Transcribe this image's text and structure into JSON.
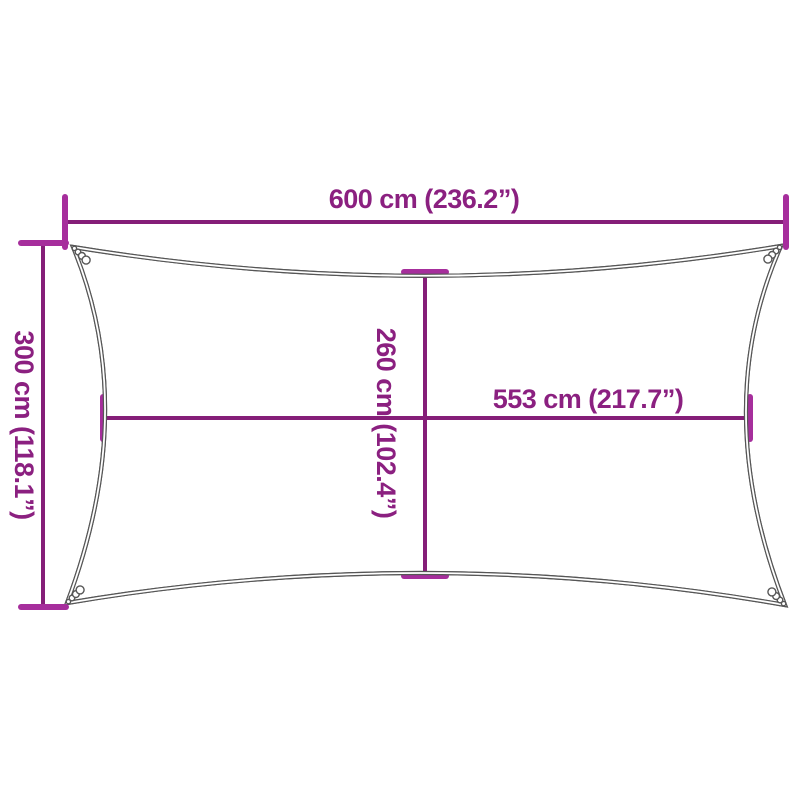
{
  "figure": {
    "type": "shade-sail-dimension-diagram",
    "labels": {
      "width_top": "600 cm (236.2”)",
      "height_left": "300 cm (118.1”)",
      "inner_height": "260 cm (102.4”)",
      "inner_width": "553 cm (217.7”)"
    },
    "colors": {
      "dimension_line": "#851E78",
      "dimension_tick": "#A62E9C",
      "dimension_text": "#8B2080",
      "sail_outline": "#565656",
      "background": "#ffffff"
    }
  }
}
